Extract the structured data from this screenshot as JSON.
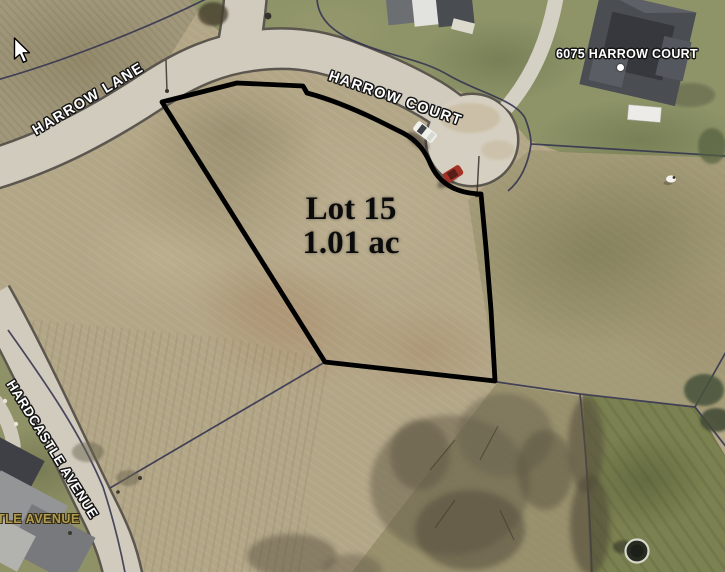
{
  "map": {
    "street_labels": [
      {
        "name": "harrow-lane",
        "text": "HARROW LANE"
      },
      {
        "name": "harrow-court",
        "text": "HARROW COURT"
      },
      {
        "name": "hardcastle-avenue",
        "text": "HARDCASTLE AVENUE"
      },
      {
        "name": "avenue-partial",
        "text": "TLE AVENUE"
      }
    ],
    "parcel_label": {
      "address": "6075 HARROW COURT"
    },
    "lot_overlay": {
      "lot_name": "Lot 15",
      "lot_area": "1.01 ac"
    },
    "colors": {
      "lot_outline": "#000000",
      "parcel_line": "#333350",
      "road_fill": "#d1cbbd",
      "road_casing": "#5b564e",
      "road_label_fill": "#ffffff",
      "basemap_label_fill": "#b09c4e",
      "field_tan": "#b3a687",
      "lawn_green": "#7b8150"
    }
  }
}
